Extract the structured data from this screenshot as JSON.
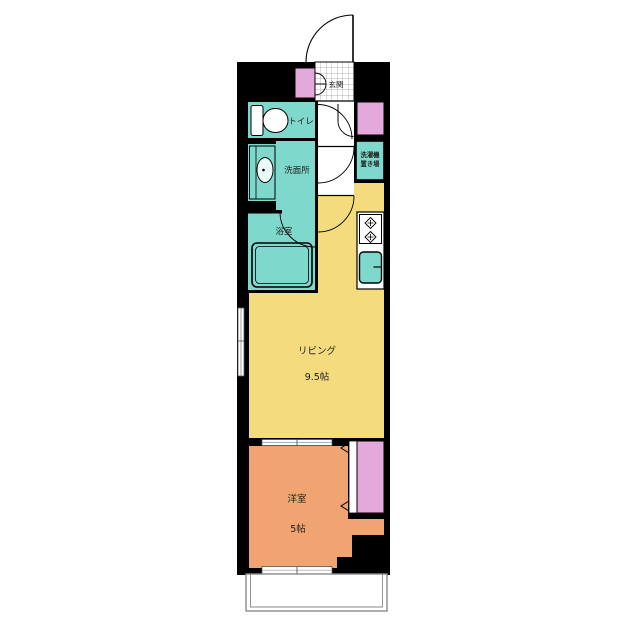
{
  "floorplan": {
    "colors": {
      "wall": "#000000",
      "background": "#ffffff",
      "wet_area": "#7ed8cc",
      "living": "#f4db7d",
      "bedroom": "#f0a471",
      "storage": "#e2a9da",
      "balcony_line": "#8a8a8a"
    },
    "rooms": {
      "genkan": {
        "label": "玄関"
      },
      "toilet": {
        "label": "トイレ"
      },
      "washroom": {
        "label": "洗面所"
      },
      "bathroom": {
        "label": "浴室"
      },
      "laundry": {
        "label_line1": "洗濯機",
        "label_line2": "置き場"
      },
      "living": {
        "label": "リビング",
        "size": "9.5帖"
      },
      "bedroom": {
        "label": "洋室",
        "size": "5帖"
      }
    }
  }
}
